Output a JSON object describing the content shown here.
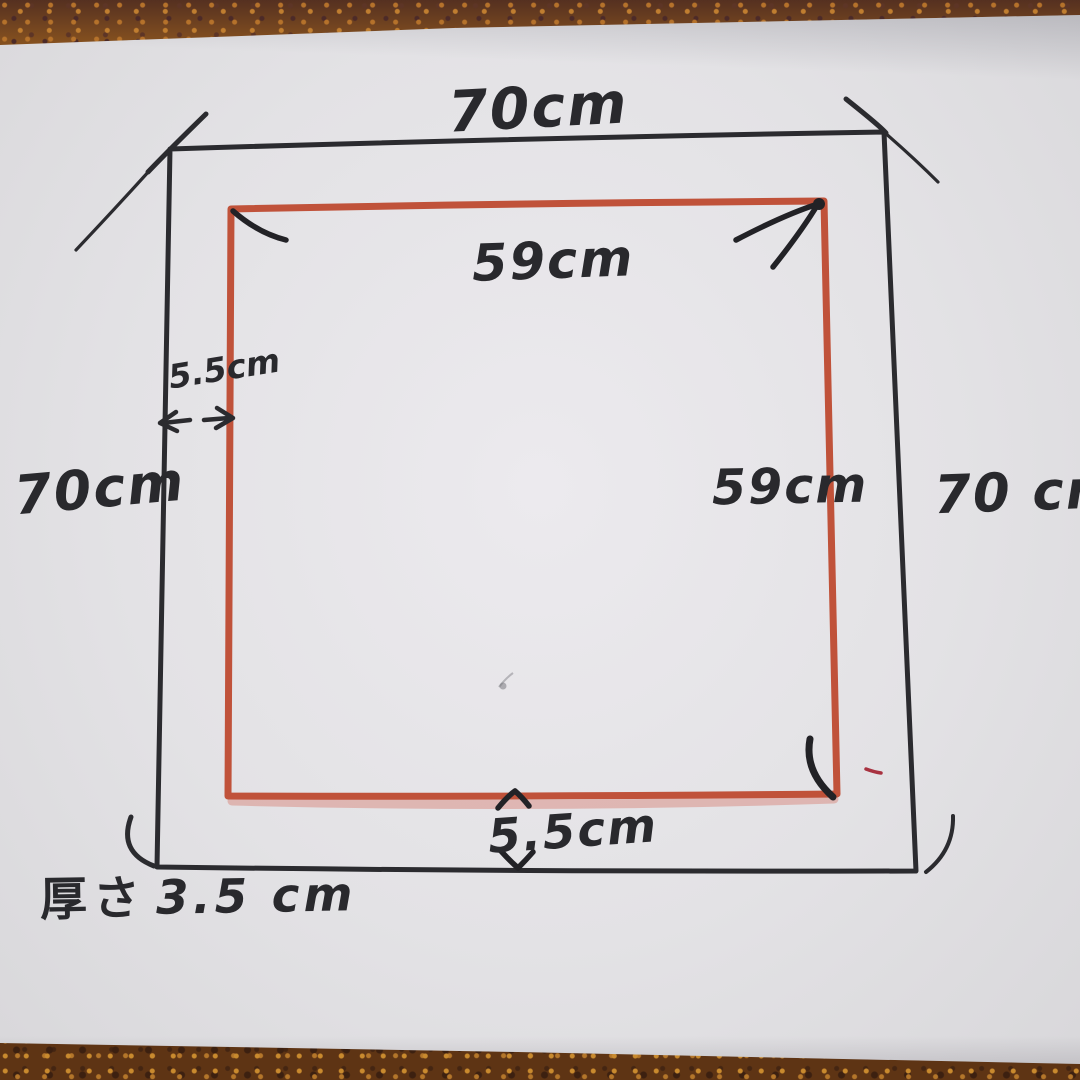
{
  "diagram": {
    "title": "hand-drawn square cushion dimension sketch",
    "labels": {
      "top_outer_width": "70cm",
      "top_inner_width": "59cm",
      "left_gap": "5.5cm",
      "left_outer_height": "70cm",
      "right_inner_height": "59cm",
      "right_outer_height": "70 cm",
      "bottom_gap": "5.5cm",
      "thickness_prefix": "厚さ",
      "thickness_value": "3.5 cm"
    },
    "colors": {
      "ink": "#2b2b2f",
      "marker_red": "#c0523a",
      "paper": "#e3e2e5",
      "wood_top": "#84501f",
      "wood_bottom": "#5e3414"
    }
  }
}
